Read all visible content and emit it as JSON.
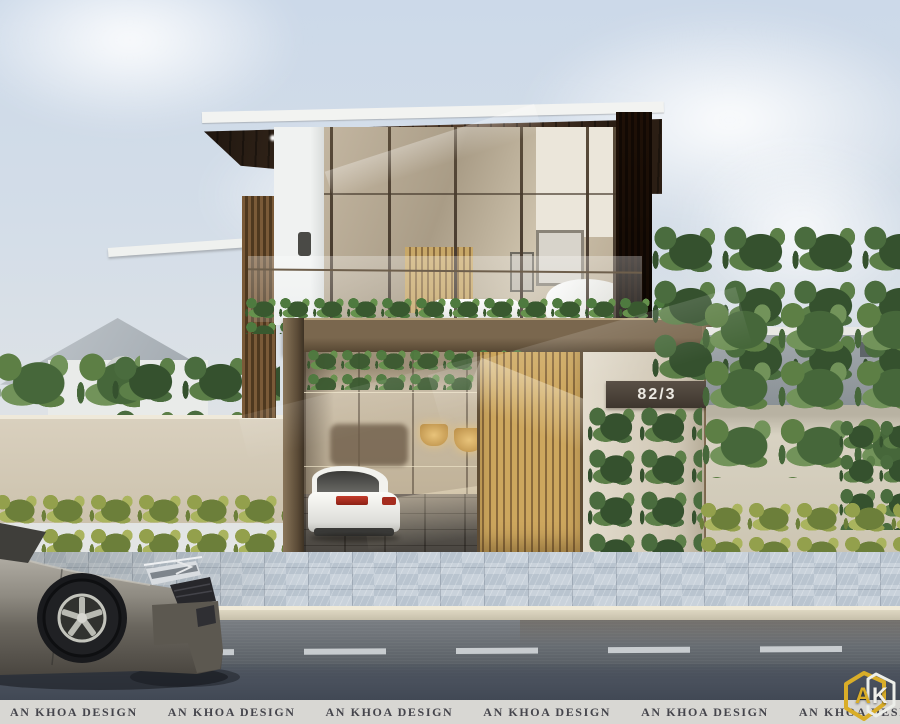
{
  "scene": {
    "description": "Architectural exterior render of a modern two-storey villa with bronze gate frame, golden slat sliding gate, rooftop planter, garage with white car, and a grey sedan on the street"
  },
  "watermark": {
    "text": "AN KHOA DESIGN",
    "repeat_count": 7,
    "band_bg": "#d8d7d3",
    "text_color": "#45454c"
  },
  "house": {
    "number_plate": "82/3",
    "plate_bg": "#453c32",
    "plate_text_color": "#ece9e2"
  },
  "logo": {
    "letter_a": "A",
    "letter_k": "K",
    "gold": "#d9ad28",
    "white": "#f0efe9"
  },
  "colors": {
    "sky_top": "#ccd9e9",
    "roof_soffit": "#3a2b1d",
    "fascia_white": "#f2f3f1",
    "bronze_frame": "#7a674e",
    "slat_gate_gold": "#c9a55e",
    "glass_warm": "#b9ac97",
    "road_dark": "#3c4450",
    "sidewalk": "#c3cdd6",
    "hedge_green": "#8a9a4e",
    "curb_cream": "#e6dfc9"
  }
}
